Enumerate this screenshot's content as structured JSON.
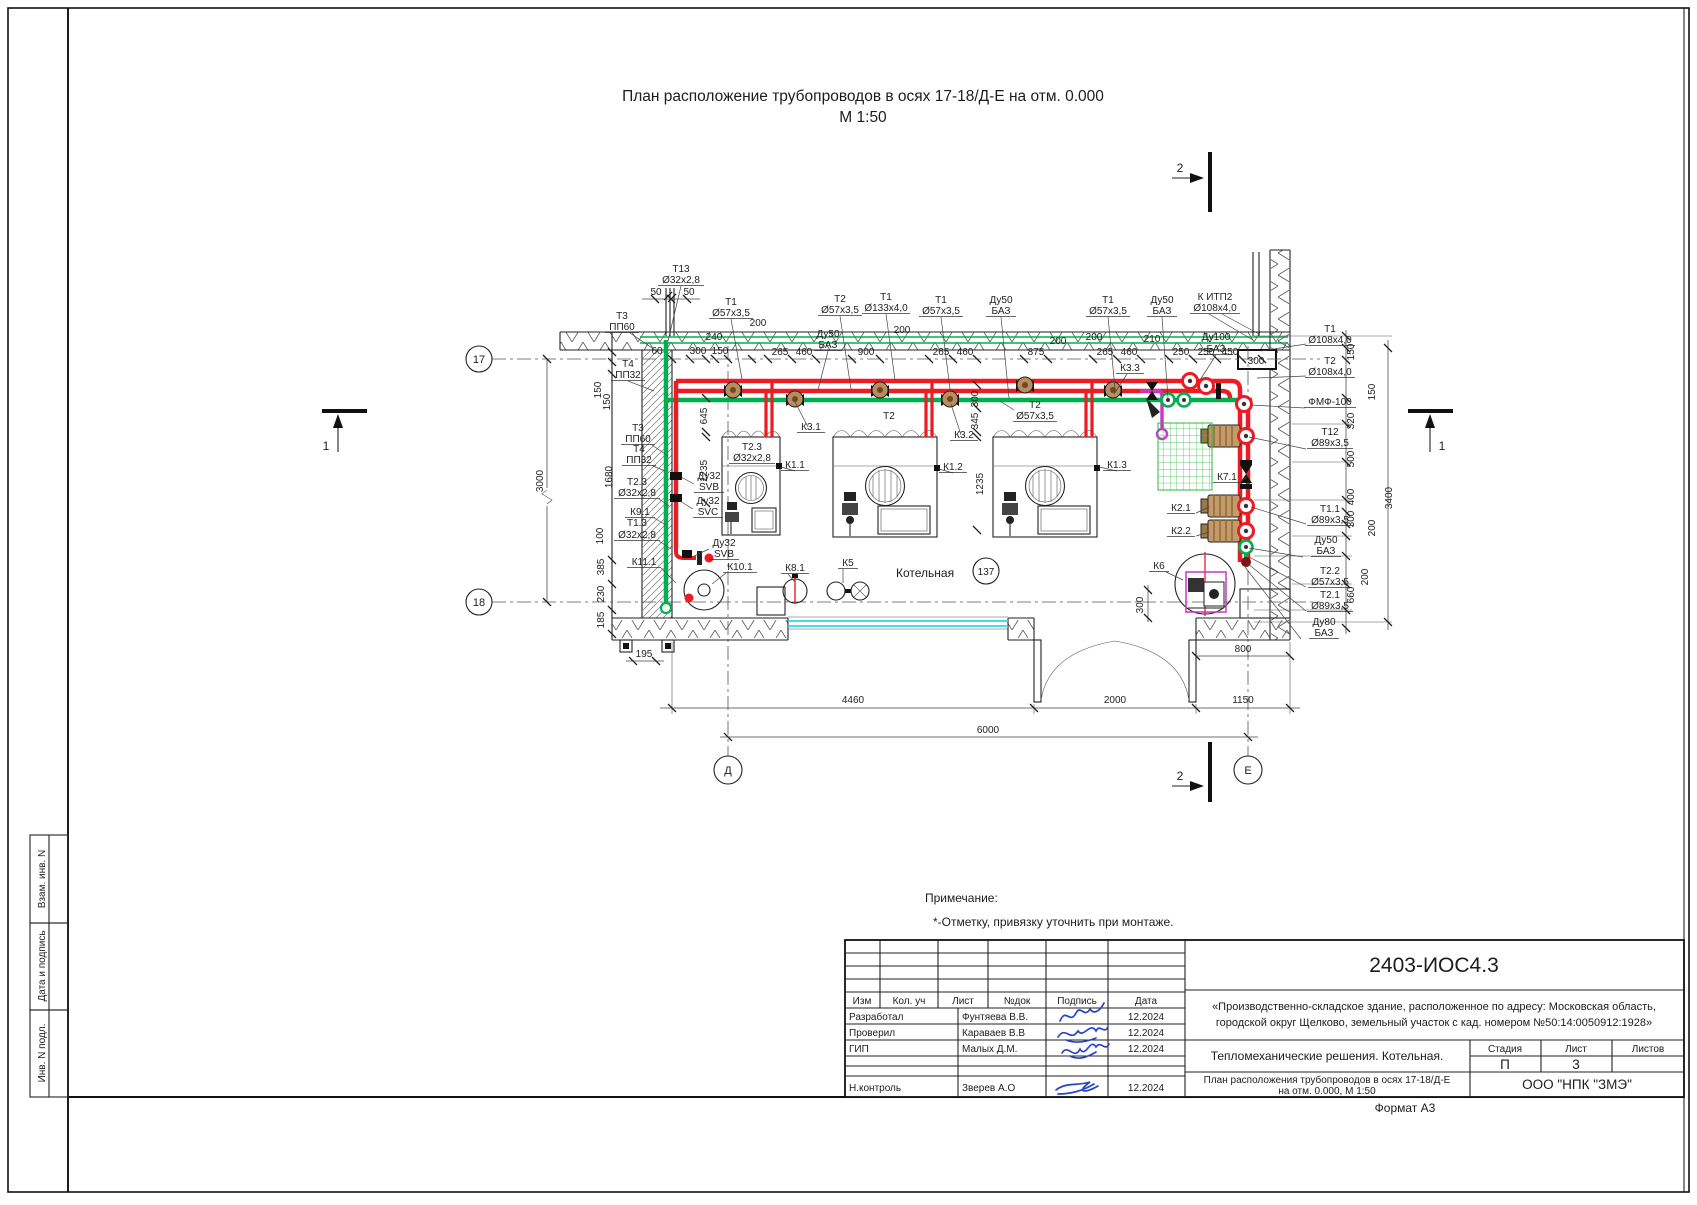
{
  "page": {
    "format_label": "Формат А3"
  },
  "title": {
    "line1": "План расположение трубопроводов в осях 17-18/Д-Е на отм. 0.000",
    "line2": "М 1:50"
  },
  "sidebar": {
    "items": [
      "Взам. инв. N",
      "Дата и подпись",
      "Инв. N подл."
    ]
  },
  "notes": {
    "heading": "Примечание:",
    "body": "*-Отметку, привязку уточнить при монтаже."
  },
  "axes": {
    "a17": "17",
    "a18": "18",
    "ad": "Д",
    "ae": "Е"
  },
  "sections": {
    "s1": "1",
    "s2": "2"
  },
  "room": {
    "name": "Котельная",
    "number": "137"
  },
  "stamp": {
    "doc_number": "2403-ИОС4.3",
    "project": [
      "«Производственно-складское здание, расположенное по адресу: Московская область,",
      "городской округ Щелково, земельный участок с кад. номером №50:14:0050912:1928»"
    ],
    "columns": [
      "Изм",
      "Кол. уч",
      "Лист",
      "№док",
      "Подпись",
      "Дата"
    ],
    "rows": [
      {
        "role": "Разработал",
        "name": "Фунтяева В.В.",
        "date": "12.2024"
      },
      {
        "role": "Проверил",
        "name": "Караваев В.В",
        "date": "12.2024"
      },
      {
        "role": "ГИП",
        "name": "Малых Д.М.",
        "date": "12.2024"
      },
      {
        "role": "Н.контроль",
        "name": "Зверев А.О",
        "date": "12.2024"
      }
    ],
    "section_title": "Тепломеханические решения. Котельная.",
    "sheet_title": [
      "План расположения трубопроводов в осях 17-18/Д-Е",
      "на отм. 0.000, М 1:50"
    ],
    "stage_label": "Стадия",
    "sheet_label": "Лист",
    "sheets_label": "Листов",
    "stage": "П",
    "sheet_no": "3",
    "company": "ООО \"НПК \"ЗМЭ\""
  },
  "colors": {
    "pipe_red": "#ed1c24",
    "pipe_green": "#00b050",
    "pipe_magenta": "#c837c8",
    "window_cyan": "#2fd5e8",
    "signature_blue": "#2843c8",
    "pump_tan": "#c69a66"
  },
  "drawing": {
    "labels": [
      {
        "t": "Т13",
        "x": 681,
        "y": 272
      },
      {
        "t": "Ø32х2,8",
        "x": 681,
        "y": 283,
        "u": 46
      },
      {
        "t": "50",
        "x": 656,
        "y": 295
      },
      {
        "t": "50",
        "x": 689,
        "y": 295
      },
      {
        "t": "Т3",
        "x": 622,
        "y": 319
      },
      {
        "t": "ПП60",
        "x": 622,
        "y": 330,
        "u": 34
      },
      {
        "t": "Т1",
        "x": 731,
        "y": 305
      },
      {
        "t": "Ø57х3,5",
        "x": 731,
        "y": 316,
        "u": 44
      },
      {
        "t": "Т2",
        "x": 840,
        "y": 302
      },
      {
        "t": "Ø57х3,5",
        "x": 840,
        "y": 313,
        "u": 44
      },
      {
        "t": "Т1",
        "x": 886,
        "y": 300
      },
      {
        "t": "Ø133х4,0",
        "x": 886,
        "y": 311,
        "u": 48
      },
      {
        "t": "Т1",
        "x": 941,
        "y": 303
      },
      {
        "t": "Ø57х3,5",
        "x": 941,
        "y": 314,
        "u": 44
      },
      {
        "t": "Ду50",
        "x": 1001,
        "y": 303
      },
      {
        "t": "БАЗ",
        "x": 1001,
        "y": 314,
        "u": 30
      },
      {
        "t": "Т1",
        "x": 1108,
        "y": 303
      },
      {
        "t": "Ø57х3,5",
        "x": 1108,
        "y": 314,
        "u": 44
      },
      {
        "t": "Ду50",
        "x": 1162,
        "y": 303
      },
      {
        "t": "БАЗ",
        "x": 1162,
        "y": 314,
        "u": 30
      },
      {
        "t": "К ИТП2",
        "x": 1215,
        "y": 300
      },
      {
        "t": "Ø108х4,0",
        "x": 1215,
        "y": 311,
        "u": 50
      },
      {
        "t": "Ду50",
        "x": 828,
        "y": 337
      },
      {
        "t": "БАЗ",
        "x": 828,
        "y": 348,
        "u": 28
      },
      {
        "t": "Ду100",
        "x": 1216,
        "y": 340
      },
      {
        "t": "БАЗ",
        "x": 1216,
        "y": 352,
        "u": 34
      },
      {
        "t": "240",
        "x": 714,
        "y": 340
      },
      {
        "t": "200",
        "x": 758,
        "y": 326
      },
      {
        "t": "200",
        "x": 902,
        "y": 333
      },
      {
        "t": "200",
        "x": 1058,
        "y": 344
      },
      {
        "t": "200",
        "x": 1094,
        "y": 340
      },
      {
        "t": "210",
        "x": 1152,
        "y": 342
      },
      {
        "t": "60",
        "x": 657,
        "y": 354
      },
      {
        "t": "300",
        "x": 698,
        "y": 354
      },
      {
        "t": "150",
        "x": 720,
        "y": 354
      },
      {
        "t": "265",
        "x": 780,
        "y": 355
      },
      {
        "t": "460",
        "x": 804,
        "y": 355
      },
      {
        "t": "900",
        "x": 866,
        "y": 355
      },
      {
        "t": "265",
        "x": 941,
        "y": 355
      },
      {
        "t": "460",
        "x": 965,
        "y": 355
      },
      {
        "t": "875",
        "x": 1036,
        "y": 355
      },
      {
        "t": "265",
        "x": 1105,
        "y": 355
      },
      {
        "t": "460",
        "x": 1129,
        "y": 355
      },
      {
        "t": "250",
        "x": 1181,
        "y": 355
      },
      {
        "t": "250",
        "x": 1206,
        "y": 355
      },
      {
        "t": "450",
        "x": 1230,
        "y": 355
      },
      {
        "t": "300",
        "x": 1256,
        "y": 364
      },
      {
        "t": "Т4",
        "x": 628,
        "y": 367
      },
      {
        "t": "ПП32",
        "x": 628,
        "y": 378,
        "u": 34
      },
      {
        "t": "150",
        "x": 601,
        "y": 390,
        "r": 1
      },
      {
        "t": "150",
        "x": 610,
        "y": 402,
        "r": 1
      },
      {
        "t": "3000",
        "x": 543,
        "y": 481,
        "r": 1
      },
      {
        "t": "1680",
        "x": 612,
        "y": 477,
        "r": 1
      },
      {
        "t": "Т3",
        "x": 638,
        "y": 431
      },
      {
        "t": "ПП60",
        "x": 638,
        "y": 442,
        "u": 34
      },
      {
        "t": "Т4",
        "x": 639,
        "y": 452
      },
      {
        "t": "ПП32",
        "x": 639,
        "y": 463,
        "u": 34
      },
      {
        "t": "Т2.3",
        "x": 637,
        "y": 485
      },
      {
        "t": "Ø32х2,8",
        "x": 637,
        "y": 496,
        "u": 46
      },
      {
        "t": "К9.1",
        "x": 640,
        "y": 515,
        "u": 30
      },
      {
        "t": "Т1.3",
        "x": 637,
        "y": 526
      },
      {
        "t": "Ø32х2,8",
        "x": 637,
        "y": 538,
        "u": 46
      },
      {
        "t": "100",
        "x": 603,
        "y": 536,
        "r": 1
      },
      {
        "t": "К11.1",
        "x": 644,
        "y": 565,
        "u": 34
      },
      {
        "t": "385",
        "x": 604,
        "y": 567,
        "r": 1
      },
      {
        "t": "230",
        "x": 604,
        "y": 594,
        "r": 1
      },
      {
        "t": "185",
        "x": 604,
        "y": 620,
        "r": 1
      },
      {
        "t": "Ду32",
        "x": 709,
        "y": 479
      },
      {
        "t": "SVB",
        "x": 709,
        "y": 490,
        "u": 30
      },
      {
        "t": "Ду32",
        "x": 708,
        "y": 504
      },
      {
        "t": "SVC",
        "x": 708,
        "y": 515,
        "u": 30
      },
      {
        "t": "Ду32",
        "x": 724,
        "y": 546
      },
      {
        "t": "SVB",
        "x": 724,
        "y": 557,
        "u": 30
      },
      {
        "t": "К10.1",
        "x": 740,
        "y": 570,
        "u": 34
      },
      {
        "t": "К8.1",
        "x": 795,
        "y": 571,
        "u": 28
      },
      {
        "t": "К5",
        "x": 848,
        "y": 566,
        "u": 20
      },
      {
        "t": "645",
        "x": 707,
        "y": 416,
        "r": 1
      },
      {
        "t": "1235",
        "x": 707,
        "y": 471,
        "r": 1
      },
      {
        "t": "Т2.3",
        "x": 752,
        "y": 450
      },
      {
        "t": "Ø32х2,8",
        "x": 752,
        "y": 461,
        "u": 46
      },
      {
        "t": "К1.1",
        "x": 795,
        "y": 468,
        "u": 28
      },
      {
        "t": "К3.1",
        "x": 811,
        "y": 430,
        "u": 28
      },
      {
        "t": "Т2",
        "x": 889,
        "y": 419
      },
      {
        "t": "К1.2",
        "x": 953,
        "y": 470,
        "u": 28
      },
      {
        "t": "К3.2",
        "x": 964,
        "y": 438,
        "u": 28
      },
      {
        "t": "300",
        "x": 978,
        "y": 399,
        "r": 1
      },
      {
        "t": "345",
        "x": 978,
        "y": 421,
        "r": 1
      },
      {
        "t": "1235",
        "x": 983,
        "y": 484,
        "r": 1
      },
      {
        "t": "Т2",
        "x": 1035,
        "y": 408
      },
      {
        "t": "Ø57х3,5",
        "x": 1035,
        "y": 419,
        "u": 44
      },
      {
        "t": "К1.3",
        "x": 1117,
        "y": 468,
        "u": 28
      },
      {
        "t": "К3.3",
        "x": 1130,
        "y": 371,
        "u": 28
      },
      {
        "t": "К7.1",
        "x": 1227,
        "y": 480,
        "u": 28
      },
      {
        "t": "К2.1",
        "x": 1181,
        "y": 511,
        "u": 28
      },
      {
        "t": "К2.2",
        "x": 1181,
        "y": 534,
        "u": 28
      },
      {
        "t": "К6",
        "x": 1159,
        "y": 569,
        "u": 20
      },
      {
        "t": "300",
        "x": 1143,
        "y": 605,
        "r": 1
      },
      {
        "t": "800",
        "x": 1243,
        "y": 652
      },
      {
        "t": "Т1",
        "x": 1330,
        "y": 332
      },
      {
        "t": "Ø108х4,0",
        "x": 1330,
        "y": 343,
        "u": 50
      },
      {
        "t": "150",
        "x": 1354,
        "y": 352,
        "r": 1
      },
      {
        "t": "Т2",
        "x": 1330,
        "y": 364
      },
      {
        "t": "Ø108х4,0",
        "x": 1330,
        "y": 375,
        "u": 50
      },
      {
        "t": "150",
        "x": 1375,
        "y": 392,
        "r": 1
      },
      {
        "t": "ФМФ-100",
        "x": 1330,
        "y": 405,
        "u": 52
      },
      {
        "t": "320",
        "x": 1354,
        "y": 421,
        "r": 1
      },
      {
        "t": "Т12",
        "x": 1330,
        "y": 435
      },
      {
        "t": "Ø89х3,5",
        "x": 1330,
        "y": 446,
        "u": 46
      },
      {
        "t": "500",
        "x": 1354,
        "y": 459,
        "r": 1
      },
      {
        "t": "400",
        "x": 1354,
        "y": 497,
        "r": 1
      },
      {
        "t": "Т1.1",
        "x": 1330,
        "y": 512
      },
      {
        "t": "Ø89х3,5",
        "x": 1330,
        "y": 523,
        "u": 46
      },
      {
        "t": "300",
        "x": 1354,
        "y": 519,
        "r": 1
      },
      {
        "t": "200",
        "x": 1375,
        "y": 528,
        "r": 1
      },
      {
        "t": "Ду50",
        "x": 1326,
        "y": 543
      },
      {
        "t": "БАЗ",
        "x": 1326,
        "y": 554,
        "u": 30
      },
      {
        "t": "Т2.2",
        "x": 1330,
        "y": 574
      },
      {
        "t": "Ø57х3,5",
        "x": 1330,
        "y": 585,
        "u": 44
      },
      {
        "t": "200",
        "x": 1368,
        "y": 577,
        "r": 1
      },
      {
        "t": "660",
        "x": 1354,
        "y": 595,
        "r": 1
      },
      {
        "t": "Т2.1",
        "x": 1330,
        "y": 598
      },
      {
        "t": "Ø89х3,5",
        "x": 1330,
        "y": 609,
        "u": 46
      },
      {
        "t": "Ду80",
        "x": 1324,
        "y": 625
      },
      {
        "t": "БАЗ",
        "x": 1324,
        "y": 636,
        "u": 30
      },
      {
        "t": "3400",
        "x": 1392,
        "y": 498,
        "r": 1
      },
      {
        "t": "195",
        "x": 644,
        "y": 657
      },
      {
        "t": "4460",
        "x": 853,
        "y": 703
      },
      {
        "t": "2000",
        "x": 1115,
        "y": 703
      },
      {
        "t": "1150",
        "x": 1243,
        "y": 703
      },
      {
        "t": "6000",
        "x": 988,
        "y": 733
      }
    ]
  }
}
